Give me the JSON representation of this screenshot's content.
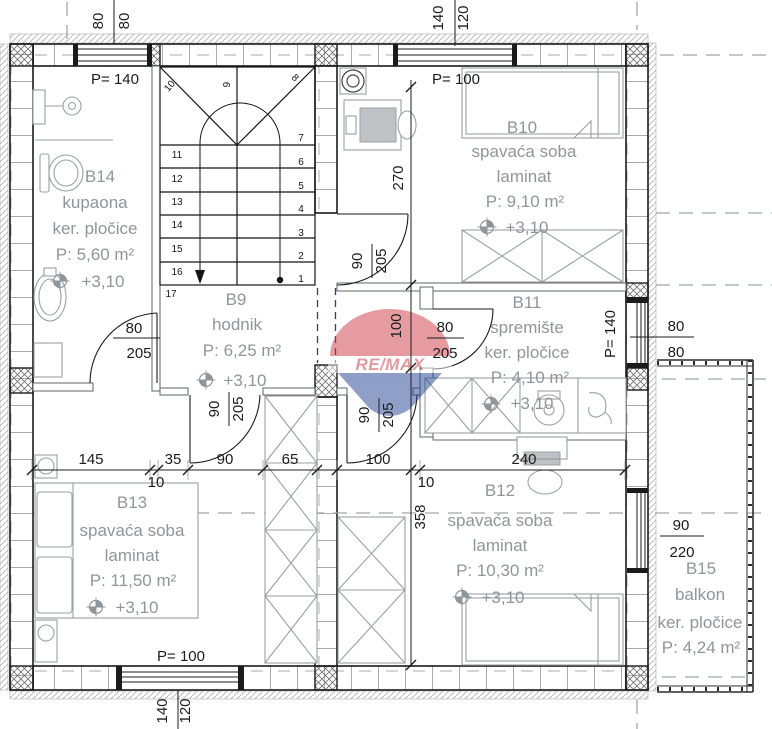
{
  "watermark": {
    "brand": "RE/MAX"
  },
  "windows": {
    "top_left": "P= 140",
    "top_right": "P= 100",
    "bottom": "P= 100",
    "right": "P= 140"
  },
  "rooms": {
    "b14": {
      "id": "B14",
      "name": "kupaona",
      "floor": "ker. pločice",
      "area": "P: 5,60 m²",
      "level": "+3,10"
    },
    "b9": {
      "id": "B9",
      "name": "hodnik",
      "area": "P: 6,25 m²",
      "level": "+3,10"
    },
    "b10": {
      "id": "B10",
      "name": "spavaća soba",
      "floor": "laminat",
      "area": "P: 9,10 m²",
      "level": "+3,10"
    },
    "b11": {
      "id": "B11",
      "name": "spremište",
      "floor": "ker. pločice",
      "area": "P: 4,10 m²",
      "level": "+3,10"
    },
    "b12": {
      "id": "B12",
      "name": "spavaća soba",
      "floor": "laminat",
      "area": "P: 10,30 m²",
      "level": "+3,10"
    },
    "b13": {
      "id": "B13",
      "name": "spavaća soba",
      "floor": "laminat",
      "area": "P: 11,50 m²",
      "level": "+3,10"
    },
    "b15": {
      "id": "B15",
      "name": "balkon",
      "floor": "ker. pločice",
      "area": "P: 4,24 m²"
    }
  },
  "dims": {
    "top_left_window": {
      "a": "80",
      "b": "80"
    },
    "top_right_window": {
      "a": "140",
      "b": "120"
    },
    "bottom_window": {
      "a": "140",
      "b": "120"
    },
    "right_wall": {
      "a": "80",
      "b": "80"
    },
    "balcony_door": {
      "a": "90",
      "b": "220"
    },
    "horizontal": [
      "145",
      "35",
      "90",
      "65",
      "100",
      "240"
    ],
    "horizontal_small": [
      "10",
      "10"
    ],
    "vertical": [
      "270",
      "100",
      "358"
    ],
    "door_b14": {
      "a": "80",
      "b": "205"
    },
    "door_b13": {
      "a": "90",
      "b": "205"
    },
    "door_b12": {
      "a": "90",
      "b": "205"
    },
    "door_b10": {
      "a": "90",
      "b": "205"
    },
    "door_b11": {
      "a": "80",
      "b": "205"
    }
  },
  "stairs": {
    "numbers": [
      "1",
      "2",
      "3",
      "4",
      "5",
      "6",
      "7",
      "8",
      "9",
      "10",
      "11",
      "12",
      "13",
      "14",
      "15",
      "16",
      "17"
    ]
  },
  "colors": {
    "wall": "#1b1b1b",
    "label_gray": "#8f969b",
    "remax_red": "#cf3a45",
    "remax_blue": "#20408f"
  }
}
